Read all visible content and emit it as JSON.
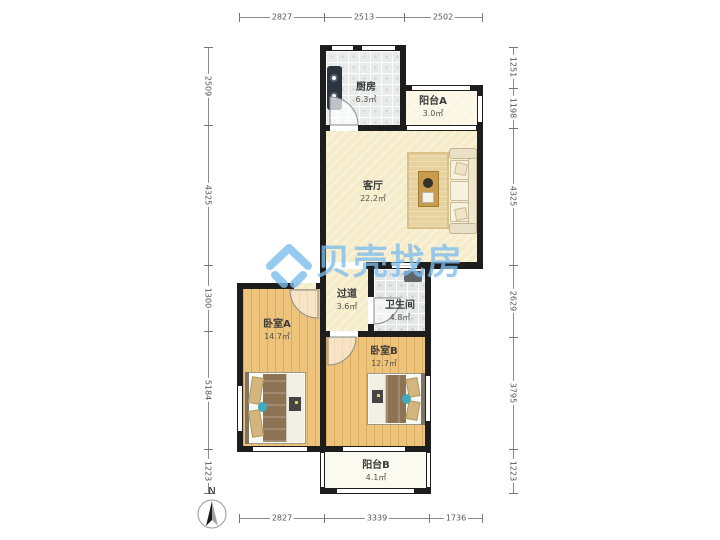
{
  "watermark": {
    "text": "贝壳找房",
    "color": "#7cbdee"
  },
  "compass": {
    "label": "N"
  },
  "rooms": [
    {
      "id": "kitchen",
      "name": "厨房",
      "area": "6.3㎡"
    },
    {
      "id": "balcony-a",
      "name": "阳台A",
      "area": "3.0㎡"
    },
    {
      "id": "living",
      "name": "客厅",
      "area": "22.2㎡"
    },
    {
      "id": "hallway",
      "name": "过道",
      "area": "3.6㎡"
    },
    {
      "id": "bathroom",
      "name": "卫生间",
      "area": "4.8㎡"
    },
    {
      "id": "bedroom-a",
      "name": "卧室A",
      "area": "14.7㎡"
    },
    {
      "id": "bedroom-b",
      "name": "卧室B",
      "area": "12.7㎡"
    },
    {
      "id": "balcony-b",
      "name": "阳台B",
      "area": "4.1㎡"
    }
  ],
  "dimensions": {
    "top": [
      "2827",
      "2513",
      "2502"
    ],
    "bottom": [
      "2827",
      "3339",
      "1736"
    ],
    "left": [
      "2509",
      "4325",
      "1300",
      "5184",
      "1223"
    ],
    "right": [
      "1251",
      "1198",
      "4325",
      "2629",
      "3795",
      "1223"
    ]
  }
}
